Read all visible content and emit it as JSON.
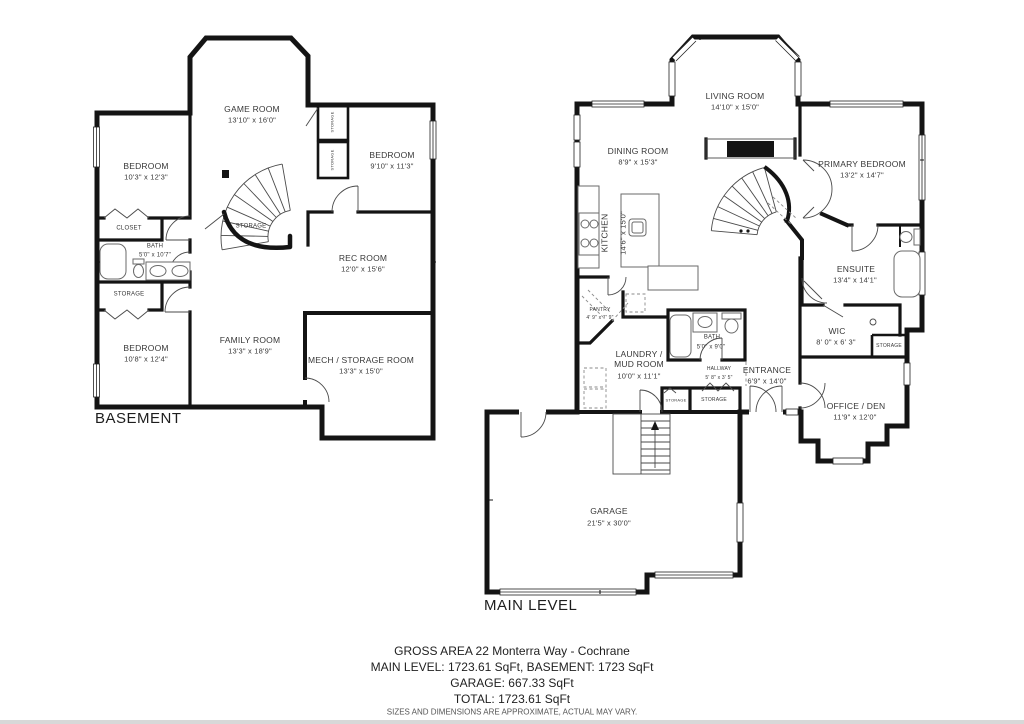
{
  "basement": {
    "label": "BASEMENT",
    "rooms": {
      "game_room": {
        "name": "GAME ROOM",
        "dims": "13'10\" x 16'0\""
      },
      "bedroom1": {
        "name": "BEDROOM",
        "dims": "10'3\" x 12'3\""
      },
      "bedroom2": {
        "name": "BEDROOM",
        "dims": "9'10\" x 11'3\""
      },
      "closet": {
        "name": "CLOSET"
      },
      "bath": {
        "name": "BATH",
        "dims": "5'0\" x 10'7\""
      },
      "storage_left": {
        "name": "STORAGE"
      },
      "bedroom3": {
        "name": "BEDROOM",
        "dims": "10'8\" x 12'4\""
      },
      "family_room": {
        "name": "FAMILY ROOM",
        "dims": "13'3\" x 18'9\""
      },
      "rec_room": {
        "name": "REC ROOM",
        "dims": "12'0\" x 15'6\""
      },
      "mech_room": {
        "name": "MECH / STORAGE ROOM",
        "dims": "13'3\" x 15'0\""
      },
      "storage_under_stairs": {
        "name": "STORAGE"
      },
      "storage_closet_a": {
        "name": "STORAGE"
      },
      "storage_closet_b": {
        "name": "STORAGE"
      }
    }
  },
  "main_level": {
    "label": "MAIN LEVEL",
    "rooms": {
      "living_room": {
        "name": "LIVING ROOM",
        "dims": "14'10\" x 15'0\""
      },
      "dining_room": {
        "name": "DINING ROOM",
        "dims": "8'9\" x 15'3\""
      },
      "kitchen": {
        "name": "KITCHEN",
        "dims": "14'6\" x 15'0\""
      },
      "primary_bedroom": {
        "name": "PRIMARY BEDROOM",
        "dims": "13'2\" x 14'7\""
      },
      "ensuite": {
        "name": "ENSUITE",
        "dims": "13'4\" x 14'1\""
      },
      "wic": {
        "name": "WIC",
        "dims": "8' 0\" x 6' 3\""
      },
      "storage_wic": {
        "name": "STORAGE"
      },
      "pantry": {
        "name": "PANTRY",
        "dims": "4' 9\" x 7' 9\""
      },
      "laundry": {
        "name": "LAUNDRY / MUD ROOM",
        "dims": "10'0\" x 11'1\""
      },
      "bath": {
        "name": "BATH",
        "dims": "5'0\" x 9'0\""
      },
      "hallway": {
        "name": "HALLWAY",
        "dims": "5' 8\" x 3' 5\""
      },
      "entrance": {
        "name": "ENTRANCE",
        "dims": "6'9\" x 14'0\""
      },
      "office": {
        "name": "OFFICE / DEN",
        "dims": "11'9\" x 12'0\""
      },
      "storage_hall_small": {
        "name": "STORAGE"
      },
      "storage_hall": {
        "name": "STORAGE"
      },
      "garage": {
        "name": "GARAGE",
        "dims": "21'5\" x 30'0\""
      }
    }
  },
  "footer": {
    "line1": "GROSS AREA 22 Monterra Way - Cochrane",
    "line2": "MAIN LEVEL: 1723.61 SqFt, BASEMENT: 1723 SqFt",
    "line3": "GARAGE: 667.33 SqFt",
    "line4": "TOTAL: 1723.61 SqFt",
    "disclaimer": "SIZES AND DIMENSIONS ARE APPROXIMATE, ACTUAL MAY VARY."
  }
}
